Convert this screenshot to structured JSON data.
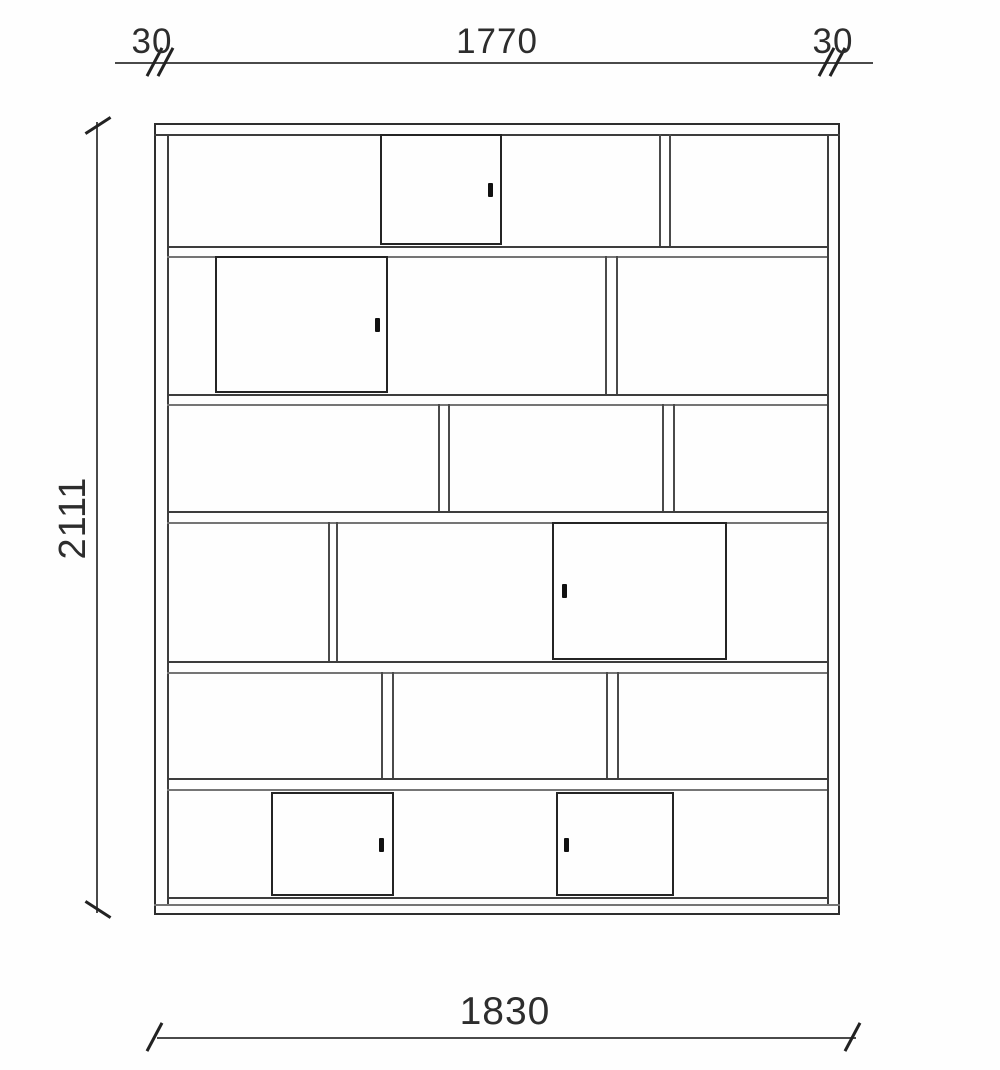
{
  "dimensions": {
    "top_left_thickness": "30",
    "top_inner_width": "1770",
    "top_right_thickness": "30",
    "total_height": "2111",
    "total_width": "1830"
  },
  "drawing": {
    "colors": {
      "outline": "#2e2e2e",
      "line_dark": "#3d3d3d",
      "line_light": "#757575",
      "divider": "#4a4a4a",
      "door": "#242424",
      "handle": "#111111"
    },
    "cabinet": {
      "outer": {
        "x": 154,
        "y": 123,
        "w": 686,
        "h": 792
      },
      "inner_left_x": 167,
      "inner_right_x": 827,
      "inner_top_y": 134,
      "bottom_shelf_y": 897,
      "bottom_inner_y": 904,
      "shelves": [
        [
          246,
          256
        ],
        [
          394,
          404
        ],
        [
          511,
          522
        ],
        [
          661,
          672
        ],
        [
          778,
          789
        ]
      ],
      "dividers": [
        {
          "x": [
            659,
            669
          ],
          "y1": 134,
          "y2": 246
        },
        {
          "x": [
            605,
            616
          ],
          "y1": 256,
          "y2": 394
        },
        {
          "x": [
            438,
            448
          ],
          "y1": 404,
          "y2": 511
        },
        {
          "x": [
            662,
            673
          ],
          "y1": 404,
          "y2": 511
        },
        {
          "x": [
            328,
            336
          ],
          "y1": 522,
          "y2": 661
        },
        {
          "x": [
            381,
            392
          ],
          "y1": 672,
          "y2": 778
        },
        {
          "x": [
            606,
            617
          ],
          "y1": 672,
          "y2": 778
        }
      ],
      "doors": [
        {
          "x": 380,
          "y": 134,
          "w": 123,
          "h": 112,
          "handle": [
            490,
            190
          ]
        },
        {
          "x": 215,
          "y": 256,
          "w": 174,
          "h": 138,
          "handle": [
            377,
            325
          ]
        },
        {
          "x": 552,
          "y": 522,
          "w": 176,
          "h": 139,
          "handle": [
            564,
            591
          ]
        },
        {
          "x": 271,
          "y": 792,
          "w": 124,
          "h": 105,
          "handle": [
            381,
            845
          ]
        },
        {
          "x": 556,
          "y": 792,
          "w": 119,
          "h": 105,
          "handle": [
            566,
            845
          ]
        }
      ]
    }
  }
}
